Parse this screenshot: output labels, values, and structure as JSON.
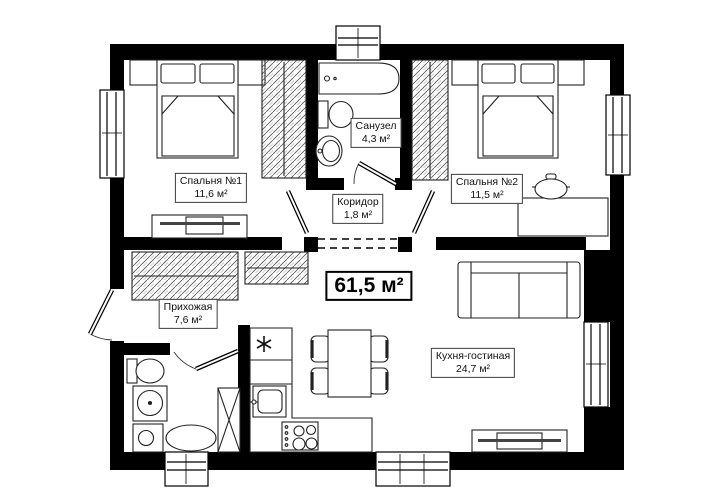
{
  "plan": {
    "type": "apartment-floor-plan",
    "total_area": "61,5 м²",
    "rooms": [
      {
        "id": "bedroom1",
        "name": "Спальня №1",
        "area": "11,6 м²"
      },
      {
        "id": "bathroom",
        "name": "Санузел",
        "area": "4,3 м²"
      },
      {
        "id": "bedroom2",
        "name": "Спальня №2",
        "area": "11,5 м²"
      },
      {
        "id": "corridor",
        "name": "Коридор",
        "area": "1,8 м²"
      },
      {
        "id": "hallway",
        "name": "Прихожая",
        "area": "7,6 м²"
      },
      {
        "id": "kitchen_living",
        "name": "Кухня-гостиная",
        "area": "24,7 м²"
      }
    ],
    "symbols": {
      "fridge_marker": "asterisk-6-ray"
    },
    "colors": {
      "wall": "#000000",
      "background": "#ffffff",
      "furniture_line": "#222222"
    }
  }
}
